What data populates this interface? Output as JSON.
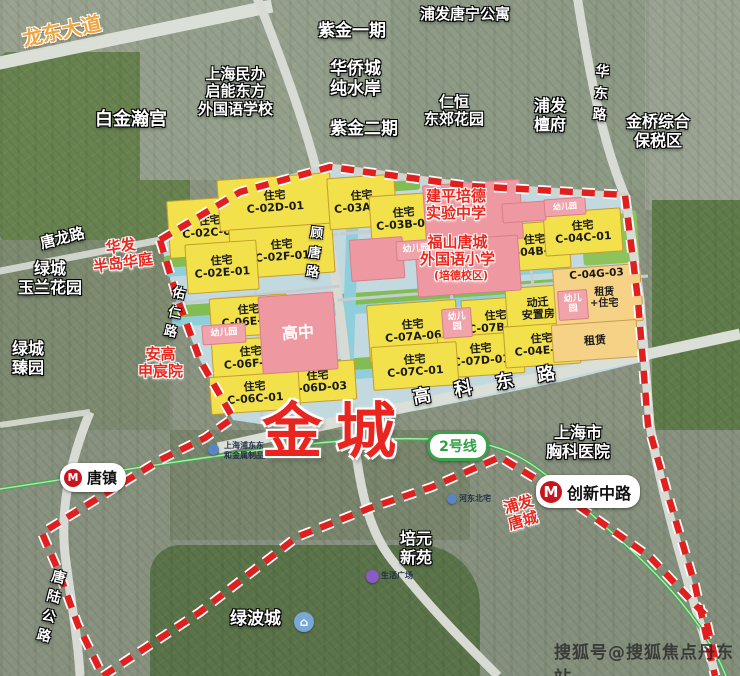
{
  "main_label": {
    "text": "金城"
  },
  "watermark": "搜狐号@搜狐焦点丹东站",
  "colors": {
    "boundary_red": "#e01f1f",
    "residential_yellow": "#f2e14b",
    "school_pink": "#ee99a1",
    "lease_orange": "#f5d285",
    "park_green": "#82bd54",
    "canal_cyan": "#8ecfdb",
    "metro_green": "#46a94f",
    "label_red": "#e8281e",
    "road_label_orange": "#f0a43c"
  },
  "metro": {
    "logo_glyph": "M",
    "line_badge": "2号线",
    "stations": [
      {
        "name": "唐镇",
        "x": 60,
        "y": 463,
        "h": 25,
        "logo": 18,
        "size": 15
      },
      {
        "name": "创新中路",
        "x": 536,
        "y": 475,
        "h": 29,
        "logo": 22,
        "size": 16
      }
    ],
    "badge": {
      "x": 427,
      "y": 431,
      "w": 56,
      "h": 24,
      "size": 14
    }
  },
  "plots": [
    {
      "name": "plot-c-02c-01",
      "kind": "res",
      "lines": [
        "住宅",
        "C-02C-01"
      ],
      "x": 168,
      "y": 198,
      "w": 82,
      "h": 56
    },
    {
      "name": "plot-c-02d-01",
      "kind": "res",
      "lines": [
        "住宅",
        "C-02D-01"
      ],
      "x": 218,
      "y": 176,
      "w": 112,
      "h": 50
    },
    {
      "name": "plot-c-02f-01",
      "kind": "res",
      "lines": [
        "住宅",
        "C-02F-01"
      ],
      "x": 230,
      "y": 226,
      "w": 102,
      "h": 48
    },
    {
      "name": "plot-c-02e-01",
      "kind": "res",
      "lines": [
        "住宅",
        "C-02E-01"
      ],
      "x": 186,
      "y": 242,
      "w": 70,
      "h": 48
    },
    {
      "name": "plot-c-03a-01",
      "kind": "res",
      "lines": [
        "住宅",
        "C-03A-01"
      ],
      "x": 328,
      "y": 176,
      "w": 66,
      "h": 50
    },
    {
      "name": "plot-c-03b-01",
      "kind": "res",
      "lines": [
        "住宅",
        "C-03B-01"
      ],
      "x": 370,
      "y": 194,
      "w": 66,
      "h": 48
    },
    {
      "name": "plot-c-04b-01",
      "kind": "res",
      "lines": [
        "住宅",
        "C-04B-01"
      ],
      "x": 500,
      "y": 222,
      "w": 68,
      "h": 46
    },
    {
      "name": "plot-c-04c-01",
      "kind": "res",
      "lines": [
        "住宅",
        "C-04C-01"
      ],
      "x": 544,
      "y": 210,
      "w": 76,
      "h": 42
    },
    {
      "name": "plot-c-07a-06",
      "kind": "res",
      "lines": [
        "住宅",
        "C-07A-06"
      ],
      "x": 368,
      "y": 302,
      "w": 88,
      "h": 56
    },
    {
      "name": "plot-c-07b-03",
      "kind": "res",
      "lines": [
        "住宅",
        "C-07B-03"
      ],
      "x": 462,
      "y": 298,
      "w": 66,
      "h": 46
    },
    {
      "name": "plot-dongqian-anzhifang",
      "kind": "res",
      "lines": [
        "动迁",
        "安置房"
      ],
      "x": 506,
      "y": 286,
      "w": 62,
      "h": 44
    },
    {
      "name": "plot-c-07d-01",
      "kind": "res",
      "lines": [
        "住宅",
        "C-07D-01"
      ],
      "x": 438,
      "y": 334,
      "w": 84,
      "h": 40
    },
    {
      "name": "plot-c-04e-05",
      "kind": "res",
      "lines": [
        "住宅",
        "C-04E-05"
      ],
      "x": 504,
      "y": 324,
      "w": 74,
      "h": 40
    },
    {
      "name": "plot-c-07c-01",
      "kind": "res",
      "lines": [
        "住宅",
        "C-07C-01"
      ],
      "x": 372,
      "y": 344,
      "w": 84,
      "h": 42
    },
    {
      "name": "plot-c-06e-01",
      "kind": "res",
      "lines": [
        "住宅",
        "C-06E-01"
      ],
      "x": 210,
      "y": 296,
      "w": 76,
      "h": 38
    },
    {
      "name": "plot-c-06f-01",
      "kind": "res",
      "lines": [
        "住宅",
        "C-06F-01"
      ],
      "x": 212,
      "y": 338,
      "w": 76,
      "h": 38
    },
    {
      "name": "plot-c-06d-03",
      "kind": "res",
      "lines": [
        "住宅",
        "C-06D-03"
      ],
      "x": 280,
      "y": 362,
      "w": 74,
      "h": 38
    },
    {
      "name": "plot-c-06c-01",
      "kind": "res",
      "lines": [
        "住宅",
        "C-06C-01"
      ],
      "x": 210,
      "y": 374,
      "w": 88,
      "h": 36
    },
    {
      "name": "plot-c-04g-03",
      "kind": "lease topalign",
      "lines": [
        "C-04G-03"
      ],
      "x": 554,
      "y": 266,
      "w": 88,
      "h": 58
    },
    {
      "name": "plot-zulin",
      "kind": "lease",
      "lines": [
        "租赁"
      ],
      "x": 552,
      "y": 322,
      "w": 84,
      "h": 36,
      "size": 11
    },
    {
      "name": "parcel-jianping-school",
      "kind": "school",
      "lines": [],
      "x": 424,
      "y": 182,
      "w": 96,
      "h": 58
    },
    {
      "name": "parcel-fushan-school",
      "kind": "school",
      "lines": [],
      "x": 416,
      "y": 238,
      "w": 102,
      "h": 54
    },
    {
      "name": "parcel-pink-a",
      "kind": "school",
      "lines": [],
      "x": 350,
      "y": 238,
      "w": 52,
      "h": 40
    },
    {
      "name": "parcel-pink-b",
      "kind": "school",
      "lines": [],
      "x": 502,
      "y": 202,
      "w": 42,
      "h": 18
    },
    {
      "name": "plot-gaozhong",
      "kind": "school",
      "lines": [
        "高中"
      ],
      "x": 260,
      "y": 294,
      "w": 74,
      "h": 76,
      "size": 16
    },
    {
      "name": "kinder-1",
      "kind": "kinder",
      "lines": [
        "幼儿园"
      ],
      "x": 396,
      "y": 240,
      "w": 38,
      "h": 18,
      "size": 9
    },
    {
      "name": "kinder-2",
      "kind": "kinder",
      "lines": [
        "幼儿园"
      ],
      "x": 544,
      "y": 198,
      "w": 40,
      "h": 16,
      "size": 8
    },
    {
      "name": "kinder-3",
      "kind": "kinder",
      "lines": [
        "幼儿",
        "园"
      ],
      "x": 442,
      "y": 308,
      "w": 28,
      "h": 28,
      "size": 9
    },
    {
      "name": "kinder-4",
      "kind": "kinder",
      "lines": [
        "幼儿",
        "园"
      ],
      "x": 558,
      "y": 290,
      "w": 28,
      "h": 28,
      "size": 9
    },
    {
      "name": "kinder-5",
      "kind": "kinder",
      "lines": [
        "幼儿园"
      ],
      "x": 202,
      "y": 324,
      "w": 42,
      "h": 18,
      "size": 9
    }
  ],
  "labels": [
    {
      "name": "label-longdong-dadao",
      "kind": "road-orange",
      "lines": [
        "龙东大道"
      ],
      "x": 22,
      "y": 20,
      "size": 20,
      "rot": -12
    },
    {
      "name": "label-baijin-hangong",
      "kind": "area-white",
      "lines": [
        "白金瀚宫"
      ],
      "x": 95,
      "y": 110,
      "size": 18
    },
    {
      "name": "label-qineng-school",
      "kind": "area-white",
      "lines": [
        "上海民办",
        "启能东方",
        "外国语学校"
      ],
      "x": 198,
      "y": 66,
      "size": 15
    },
    {
      "name": "label-zijin-yiqi",
      "kind": "area-white",
      "lines": [
        "紫金一期"
      ],
      "x": 318,
      "y": 22,
      "size": 17
    },
    {
      "name": "label-huaqiaocheng",
      "kind": "area-white",
      "lines": [
        "华侨城",
        "纯水岸"
      ],
      "x": 330,
      "y": 60,
      "size": 17
    },
    {
      "name": "label-zijin-erqi",
      "kind": "area-white",
      "lines": [
        "紫金二期"
      ],
      "x": 330,
      "y": 120,
      "size": 17
    },
    {
      "name": "label-pufa-tangning",
      "kind": "area-white",
      "lines": [
        "浦发唐宁公寓"
      ],
      "x": 420,
      "y": 6,
      "size": 15
    },
    {
      "name": "label-renheng-dongjiao",
      "kind": "area-white",
      "lines": [
        "仁恒",
        "东郊花园"
      ],
      "x": 424,
      "y": 94,
      "size": 15
    },
    {
      "name": "label-pufa-tanfu",
      "kind": "area-white",
      "lines": [
        "浦发",
        "檀府"
      ],
      "x": 534,
      "y": 97,
      "size": 16
    },
    {
      "name": "label-jinqiao-baoshuiqu",
      "kind": "area-white",
      "lines": [
        "金桥综合",
        "保税区"
      ],
      "x": 626,
      "y": 113,
      "size": 16
    },
    {
      "name": "label-huadong-rd",
      "kind": "road-white",
      "lines": [
        "华",
        "东",
        "路"
      ],
      "x": 594,
      "y": 62,
      "size": 14,
      "rot": 4,
      "lh": 1.55
    },
    {
      "name": "label-tanglong-rd",
      "kind": "road-white",
      "lines": [
        "唐龙路"
      ],
      "x": 40,
      "y": 230,
      "size": 15,
      "rot": -14
    },
    {
      "name": "label-huafa-bandao",
      "kind": "place-red",
      "lines": [
        "华发",
        "半岛华庭"
      ],
      "x": 92,
      "y": 238,
      "size": 15,
      "rot": -8
    },
    {
      "name": "label-lvcheng-yulan",
      "kind": "area-white",
      "lines": [
        "绿城",
        "玉兰花园"
      ],
      "x": 18,
      "y": 260,
      "size": 16
    },
    {
      "name": "label-youren-rd",
      "kind": "road-white",
      "lines": [
        "佑",
        "仁",
        "路"
      ],
      "x": 168,
      "y": 284,
      "size": 13,
      "rot": 12,
      "lh": 1.5
    },
    {
      "name": "label-gutang-rd",
      "kind": "road-white",
      "lines": [
        "顾",
        "唐",
        "路"
      ],
      "x": 308,
      "y": 224,
      "size": 13,
      "rot": 6,
      "lh": 1.5
    },
    {
      "name": "label-lvcheng-zhenyuan",
      "kind": "area-white",
      "lines": [
        "绿城",
        "臻园"
      ],
      "x": 12,
      "y": 340,
      "size": 16
    },
    {
      "name": "label-angao-shenchenyuan",
      "kind": "place-red",
      "lines": [
        "安高",
        "申宸院"
      ],
      "x": 138,
      "y": 346,
      "size": 15
    },
    {
      "name": "label-jianping-peide",
      "kind": "place-red",
      "lines": [
        "建平培德",
        "实验中学"
      ],
      "x": 426,
      "y": 188,
      "size": 15
    },
    {
      "name": "label-fushan-tangcheng",
      "kind": "place-red",
      "lines": [
        "福山唐城",
        "外国语小学"
      ],
      "x": 420,
      "y": 234,
      "size": 15
    },
    {
      "name": "label-peide-xiaoqu",
      "kind": "place-red",
      "lines": [
        "(培德校区)"
      ],
      "x": 434,
      "y": 270,
      "size": 11
    },
    {
      "name": "label-zulin-zhuzhai-note",
      "kind": "plot-note",
      "lines": [
        "租赁",
        "+住宅"
      ],
      "x": 590,
      "y": 288,
      "size": 10
    },
    {
      "name": "label-gaoke-east-rd",
      "kind": "road-white",
      "lines": [
        "高科东路"
      ],
      "x": 412,
      "y": 374,
      "size": 18,
      "rot": -10,
      "ls": 24
    },
    {
      "name": "label-chest-hospital",
      "kind": "area-white",
      "lines": [
        "上海市",
        "胸科医院"
      ],
      "x": 546,
      "y": 424,
      "size": 16
    },
    {
      "name": "label-pufa-tangcheng",
      "kind": "place-red",
      "lines": [
        "浦发",
        "唐城"
      ],
      "x": 506,
      "y": 496,
      "size": 15,
      "rot": -16
    },
    {
      "name": "label-peiyuan-xinyuan",
      "kind": "area-white",
      "lines": [
        "培元",
        "新苑"
      ],
      "x": 400,
      "y": 530,
      "size": 16
    },
    {
      "name": "label-lvbocheng",
      "kind": "area-white",
      "lines": [
        "绿波城"
      ],
      "x": 230,
      "y": 610,
      "size": 17
    },
    {
      "name": "label-tanglu-highway",
      "kind": "road-white",
      "lines": [
        "唐",
        "陆",
        "公",
        "路"
      ],
      "x": 44,
      "y": 568,
      "size": 14,
      "rot": 14,
      "lh": 1.42
    },
    {
      "name": "label-factory-tiny",
      "kind": "tiny",
      "lines": [
        "上海浦东东",
        "和金属制品厂"
      ],
      "x": 224,
      "y": 441,
      "size": 8
    },
    {
      "name": "label-hedongbeizhai-tiny",
      "kind": "tiny",
      "lines": [
        "河东北宅"
      ],
      "x": 459,
      "y": 494,
      "size": 8
    },
    {
      "name": "label-shenghuo-plaza-tiny",
      "kind": "tiny",
      "lines": [
        "生活广场"
      ],
      "x": 381,
      "y": 571,
      "size": 8
    }
  ],
  "poi_icons": [
    {
      "name": "lvbocheng-icon",
      "x": 294,
      "y": 612,
      "d": 20,
      "color": "#7aa7d6",
      "glyph": "⌂",
      "size": 12
    },
    {
      "name": "factory-icon",
      "x": 208,
      "y": 444,
      "d": 11,
      "color": "#5b84c4",
      "glyph": "",
      "size": 6
    },
    {
      "name": "hedongbeizhai-icon",
      "x": 447,
      "y": 494,
      "d": 10,
      "color": "#5b84c4",
      "glyph": "",
      "size": 6
    },
    {
      "name": "plaza-icon",
      "x": 366,
      "y": 570,
      "d": 13,
      "color": "#8a5bc4",
      "glyph": "",
      "size": 6
    }
  ]
}
